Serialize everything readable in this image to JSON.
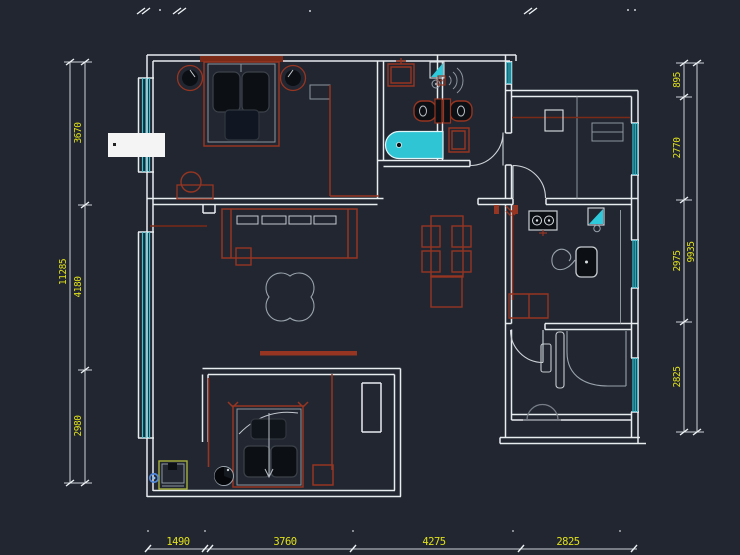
{
  "canvas": {
    "width": 740,
    "height": 555,
    "background": "#212631",
    "type": "cad-floor-plan-viewport"
  },
  "colors": {
    "background": "#212631",
    "walls": "#e8ecef",
    "wall_detail_gray": "#8f969e",
    "furniture_red": "#963521",
    "glazing_cyan": "#2ec9da",
    "bathtub_fill": "#2fc5d5",
    "dimension_text_yellow": "#e0e01a",
    "dimension_line": "#cfd4d9",
    "fixture_dark_fill": "#0c0f13",
    "drain_blue": "#4f86d8",
    "washer_accent": "#a8b23c",
    "label_box_white": "#f4f4f4"
  },
  "dimensions": {
    "left": {
      "overall": "11285",
      "segments": [
        "3670",
        "4180",
        "2980"
      ]
    },
    "right": {
      "overall": "9935",
      "segments": [
        "895",
        "2770",
        "2975",
        "2825"
      ]
    },
    "bottom": {
      "segments": [
        "1490",
        "3760",
        "4275",
        "2825"
      ]
    }
  },
  "fixtures": [
    "double-bed",
    "nightstand-lamp",
    "wardrobe",
    "dressing-stool",
    "washbasin",
    "floor-drain",
    "shower-head",
    "toilet",
    "bathtub",
    "bath-cabinet",
    "sofa",
    "sofa-cushions",
    "side-table",
    "clover-rug",
    "tv-console",
    "radiator",
    "dining-table",
    "dining-chair",
    "sideboard",
    "kitchen-counter",
    "gas-stove",
    "kitchen-sink",
    "faucet",
    "refrigerator",
    "base-cabinet",
    "desk-counter",
    "desk-chair",
    "wash-stand",
    "bed-with-pillows",
    "potted-plant",
    "washing-machine",
    "drain-point",
    "door-swing",
    "window-glazing"
  ]
}
